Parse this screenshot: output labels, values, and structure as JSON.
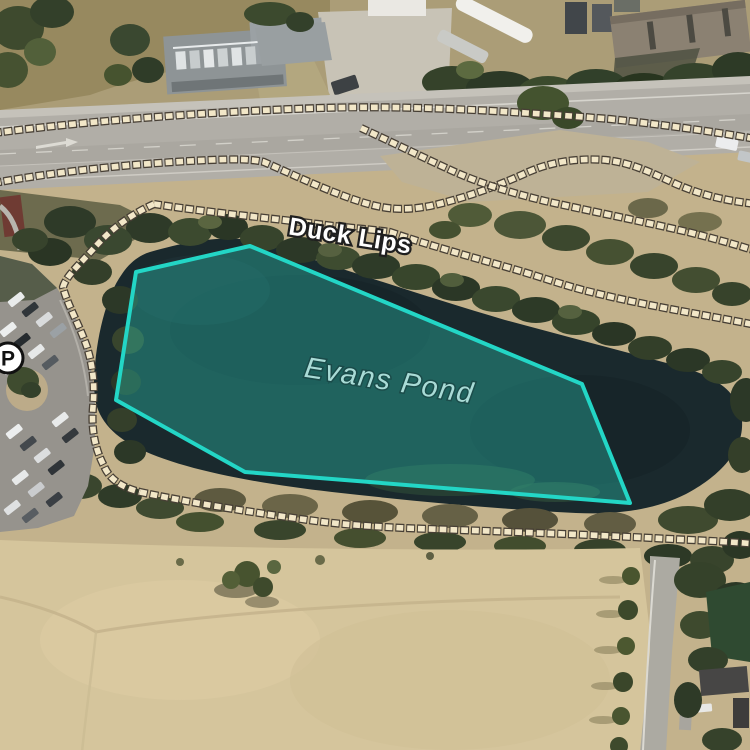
{
  "map": {
    "type": "aerial-trail-map",
    "labels": {
      "trail_label": {
        "text": "Duck Lips",
        "color": "#ffffff",
        "halo_color": "#1f1f1f"
      },
      "water_label": {
        "text": "Evans Pond",
        "color": "#a9dbd6"
      }
    },
    "marker": {
      "parking": {
        "glyph": "P",
        "fill": "#ffffff",
        "stroke": "#111111"
      }
    },
    "pond": {
      "name": "Evans Pond",
      "points": "250,246 582,384 630,503 245,472 116,400 136,272",
      "stroke_color": "#23d6c6",
      "fill_color": "rgba(45,212,191,0.34)"
    },
    "trails": {
      "dash_color": "#f2e7c8",
      "outline_color": "#473f35",
      "paths": [
        {
          "name": "roadside-path",
          "d": "M -6,133 C 80,122 200,112 320,108 C 420,105 520,112 610,119 C 665,125 710,131 756,139"
        },
        {
          "name": "north-loop-path",
          "d": "M -6,183 C 60,171 140,163 210,160 C 235,159 252,159 264,162 C 296,176 338,196 372,205 C 392,210 408,210 430,206 C 462,199 498,186 526,173 C 552,161 580,158 606,160 C 632,163 650,172 676,184 C 704,196 728,201 756,204"
        },
        {
          "name": "crossing-path",
          "d": "M 361,128 C 392,142 424,158 455,172 C 482,184 512,193 545,201 C 590,211 640,221 688,232 C 712,238 734,244 756,251"
        },
        {
          "name": "duck-lips-path",
          "d": "M 154,204 C 205,212 268,218 318,224 C 348,228 370,229 390,232 C 425,244 468,256 510,268 C 545,278 565,286 595,293 C 648,306 700,314 756,325"
        },
        {
          "name": "west-shore-path",
          "d": "M 154,204 C 132,214 112,228 96,246 C 80,264 66,276 63,287 C 67,304 79,324 87,347 C 93,367 95,384 93,407 C 91,429 95,449 104,466 C 109,478 120,487 140,492"
        },
        {
          "name": "south-shore-path",
          "d": "M 140,492 C 192,503 244,511 294,518 C 334,524 364,526 404,528 C 455,530 555,533 652,538 C 688,540 722,541 756,544"
        }
      ]
    }
  }
}
